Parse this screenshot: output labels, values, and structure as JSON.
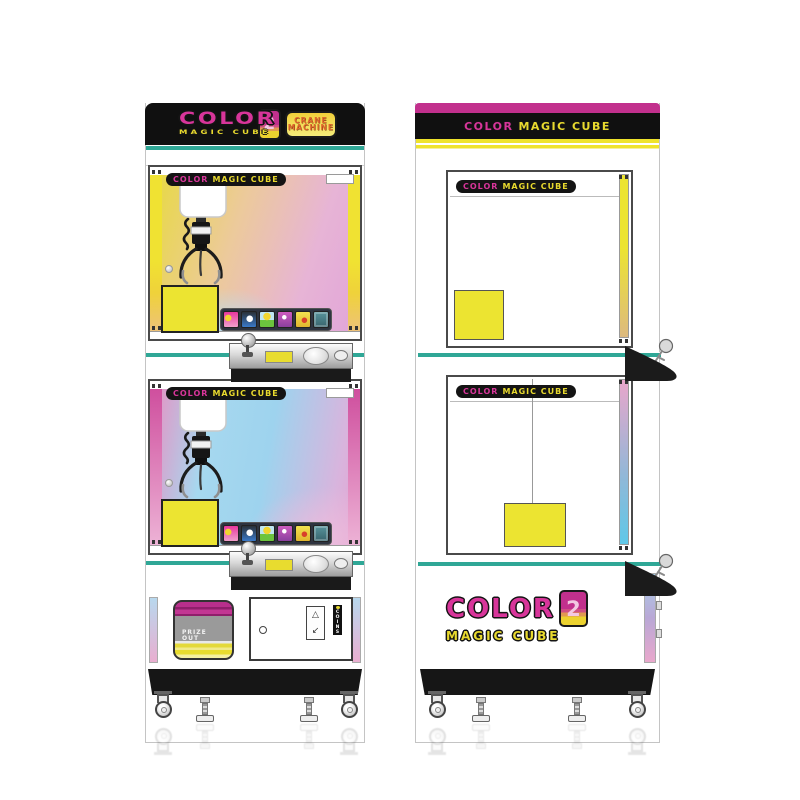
{
  "front": {
    "marquee": {
      "color_word": "COLOR",
      "magic_word": "MAGIC CUBE",
      "number": "2",
      "crane_word": "CRANE",
      "machine_word": "MACHINE"
    },
    "window_banner": {
      "color_word": "COLOR",
      "magic_word": "MAGIC CUBE"
    },
    "prize_door": {
      "line1": "PRIZE",
      "line2": "OUT"
    },
    "coin_tag": "COINS"
  },
  "side": {
    "marquee": {
      "color_word": "COLOR",
      "magic_word": "MAGIC CUBE"
    },
    "window_banner": {
      "color_word": "COLOR",
      "magic_word": "MAGIC CUBE"
    },
    "logo": {
      "color_word": "COLOR",
      "number": "2",
      "magic_word": "MAGIC CUBE"
    }
  },
  "icons": {
    "warning": "△",
    "lever": "↙"
  },
  "colors": {
    "magenta": "#c9308e",
    "yellow": "#efe32b",
    "teal": "#2fa796",
    "cabinet_black": "#141414"
  }
}
